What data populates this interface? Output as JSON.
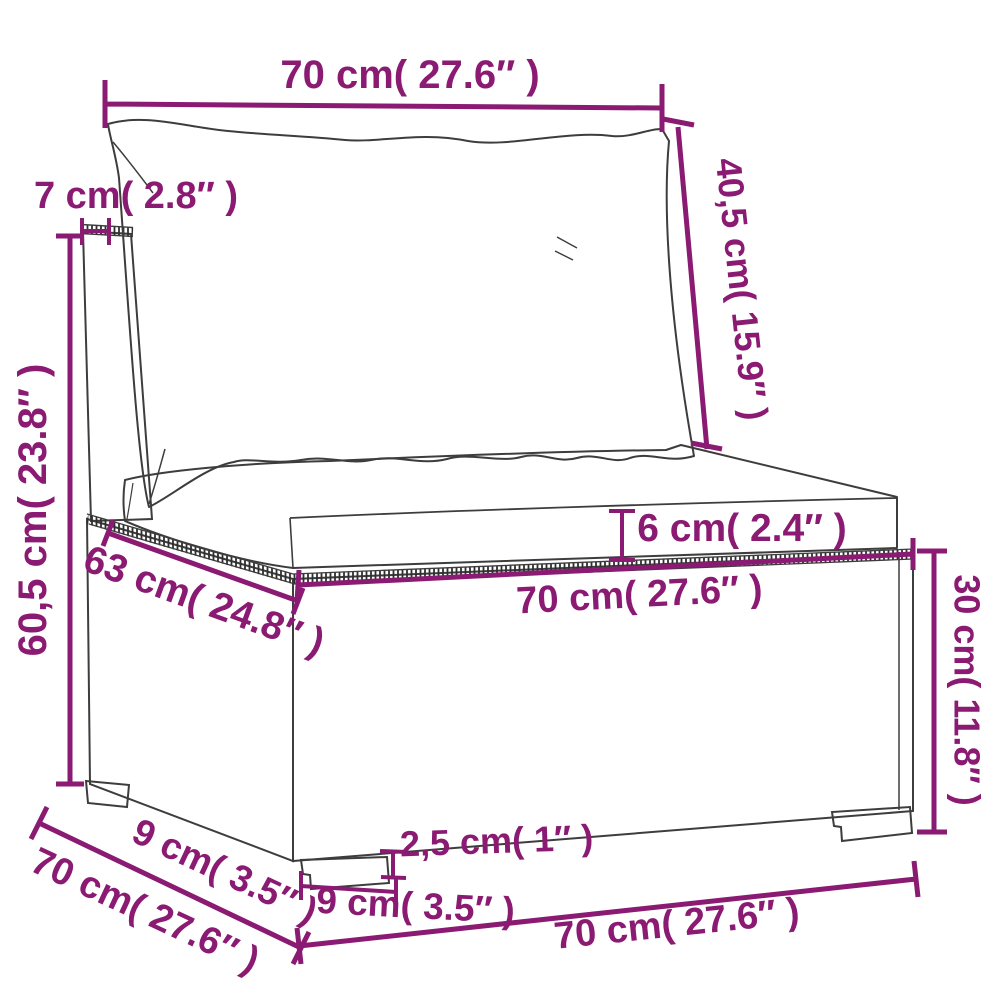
{
  "meta": {
    "figure_type": "product-dimension-diagram",
    "subject": "poly-rattan sectional sofa middle seat with back cushion and seat cushion",
    "background_color": "#ffffff",
    "dimension_color": "#8a1a72",
    "drawing_line_color": "#3d3d3d"
  },
  "dimensions": {
    "back_cushion_width": "70 cm( 27.6″ )",
    "back_frame_thickness": "7 cm( 2.8″ )",
    "back_cushion_height": "40,5 cm( 15.9″ )",
    "total_height": "60,5 cm( 23.8″ )",
    "seat_cushion_thickness": "6 cm( 2.4″ )",
    "seat_depth": "63 cm( 24.8″ )",
    "seat_width": "70 cm( 27.6″ )",
    "base_height": "30 cm( 11.8″ )",
    "foot_inset_depth": "9 cm( 3.5″ )",
    "overall_depth": "70 cm( 27.6″ )",
    "foot_height": "2,5 cm( 1″ )",
    "foot_width": "9 cm( 3.5″ )",
    "overall_width": "70 cm( 27.6″ )"
  }
}
